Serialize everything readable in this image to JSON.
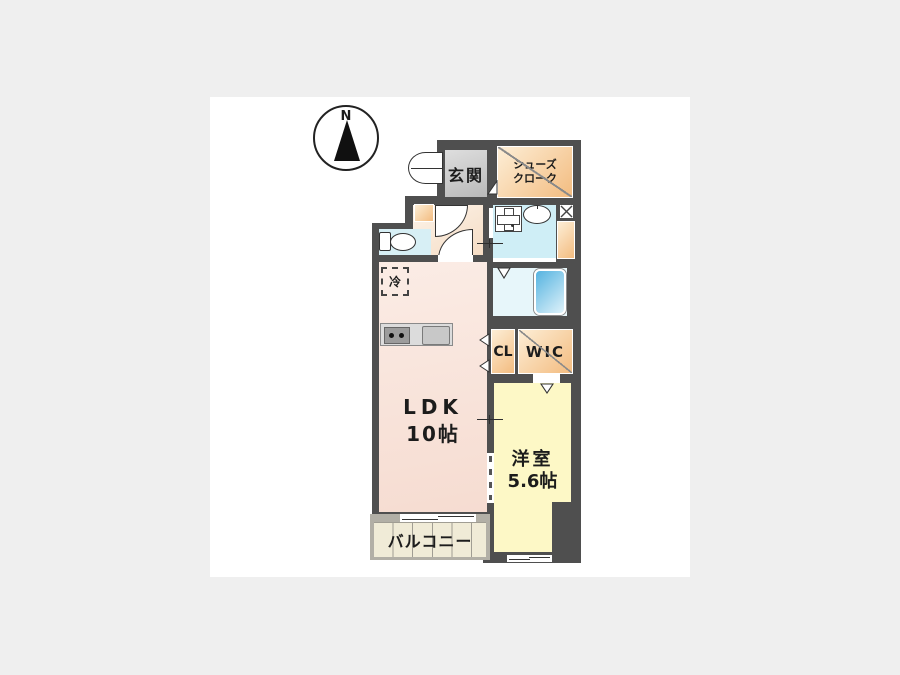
{
  "compass": {
    "north_label": "N"
  },
  "rooms": {
    "entrance": {
      "label": "玄関"
    },
    "shoe_closet": {
      "label_lines": [
        "シューズ",
        "クローク"
      ]
    },
    "ldk": {
      "label": "LDK",
      "size": "10帖"
    },
    "closet": {
      "label": "CL"
    },
    "walk_in_closet": {
      "label": "WIC"
    },
    "western_room": {
      "label": "洋室",
      "size": "5.6帖"
    },
    "balcony": {
      "label": "バルコニー"
    },
    "refrigerator_space": {
      "label": "冷"
    }
  },
  "fixtures": {
    "icons": [
      "compass-north-arrow",
      "entrance-door-arc",
      "toilet",
      "washing-machine-pan",
      "washbasin",
      "pipe-space-x",
      "bathtub",
      "kitchen-stove",
      "kitchen-sink",
      "sliding-window",
      "closet-door-chevron"
    ]
  },
  "colors": {
    "background": "#efefef",
    "wall": "#4f4f4f",
    "ldk_pink": "#f9e3da",
    "western_room_yellow": "#fdf8c6",
    "wet_area_blue": "#d2eef6",
    "closet_orange": "#f5c48c",
    "entrance_gray": "#cdcdcd",
    "balcony_cream": "#f0ebd7",
    "bathtub_blue": "#55b3e0"
  }
}
